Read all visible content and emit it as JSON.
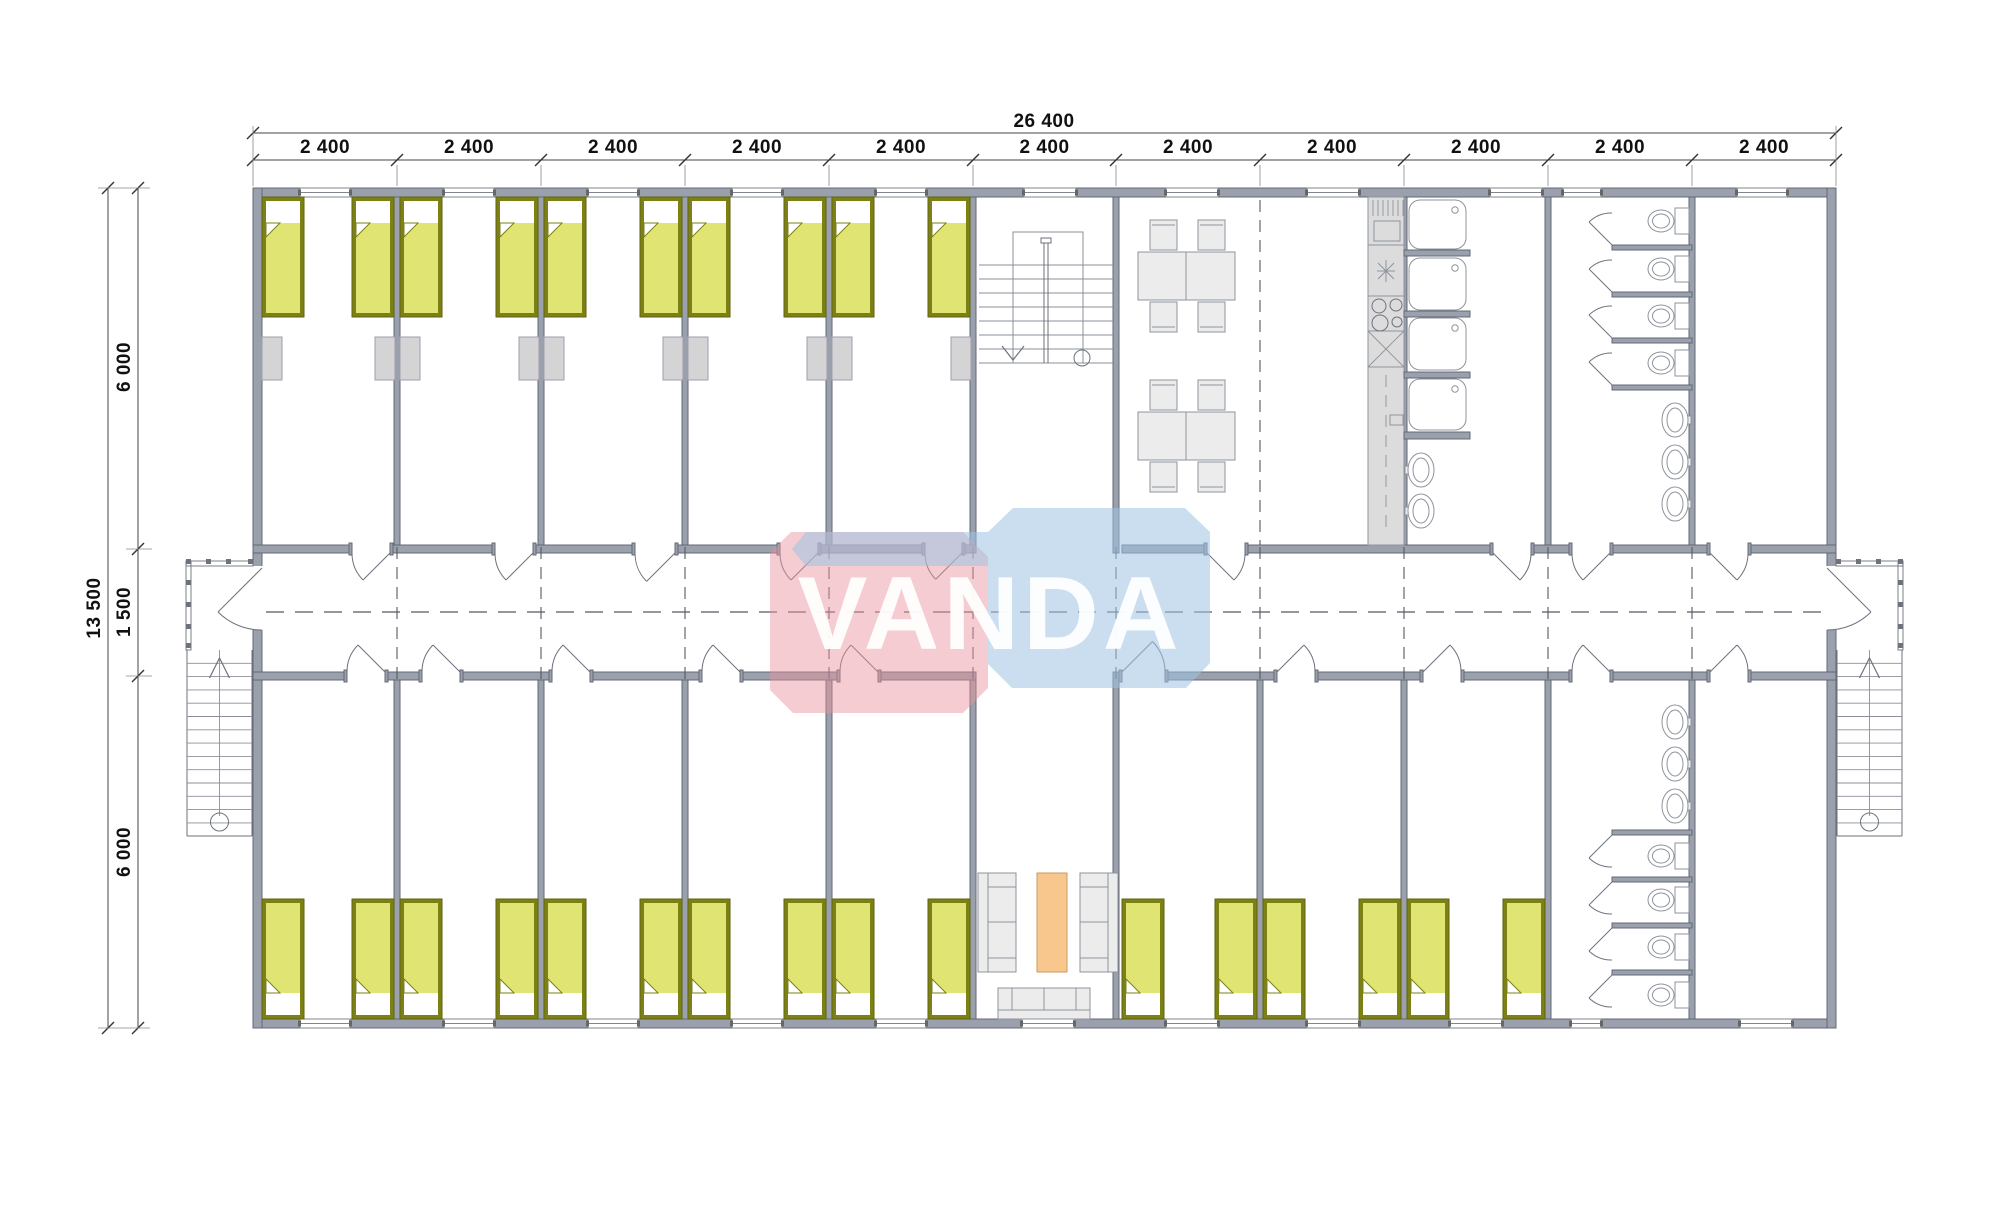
{
  "watermark": {
    "text": "VANDA"
  },
  "dimensions": {
    "top": {
      "overall": "26 400",
      "segments": [
        "2 400",
        "2 400",
        "2 400",
        "2 400",
        "2 400",
        "2 400",
        "2 400",
        "2 400",
        "2 400",
        "2 400",
        "2 400"
      ]
    },
    "left": {
      "overall": "13 500",
      "segments": [
        "6 000",
        "1 500",
        "6 000"
      ]
    }
  },
  "fixtures": {
    "beds": 26,
    "wardrobes": 10,
    "dining_tables": 2,
    "dining_chairs": 8,
    "sofas": 3,
    "coffee_tables": 1,
    "shower_trays": 4,
    "toilets": 8,
    "washbasins": 8,
    "staircases": 3
  },
  "symbols": {
    "bed": "rect-with-pillow-and-folded-blanket",
    "toilet": "tank-and-oval-bowl",
    "washbasin": "oval-with-tap",
    "shower": "rounded-square-with-drain",
    "door": "quarter-arc-swing",
    "window": "double-line-wall-gap",
    "staircase": "parallel-treads-with-direction-arrow"
  },
  "colors": {
    "wall_fill": "#9aa1ac",
    "wall_stroke": "#636974",
    "line": "#6d727d",
    "thin_line": "#8a8f99",
    "dash_line": "#555a63",
    "bed_fill": "#e0e472",
    "bed_frame": "#7c8116",
    "pillow": "#ffffff",
    "locker_fill": "#d4d4d4",
    "furniture_fill": "#ececec",
    "furniture_stroke": "#8e939b",
    "counter_fill": "#dcdcdc",
    "orange_table": "#f8c78d",
    "watermark_pink": "#e8939e",
    "watermark_blue": "#9fc3e2",
    "dimension_text": "#111111"
  }
}
